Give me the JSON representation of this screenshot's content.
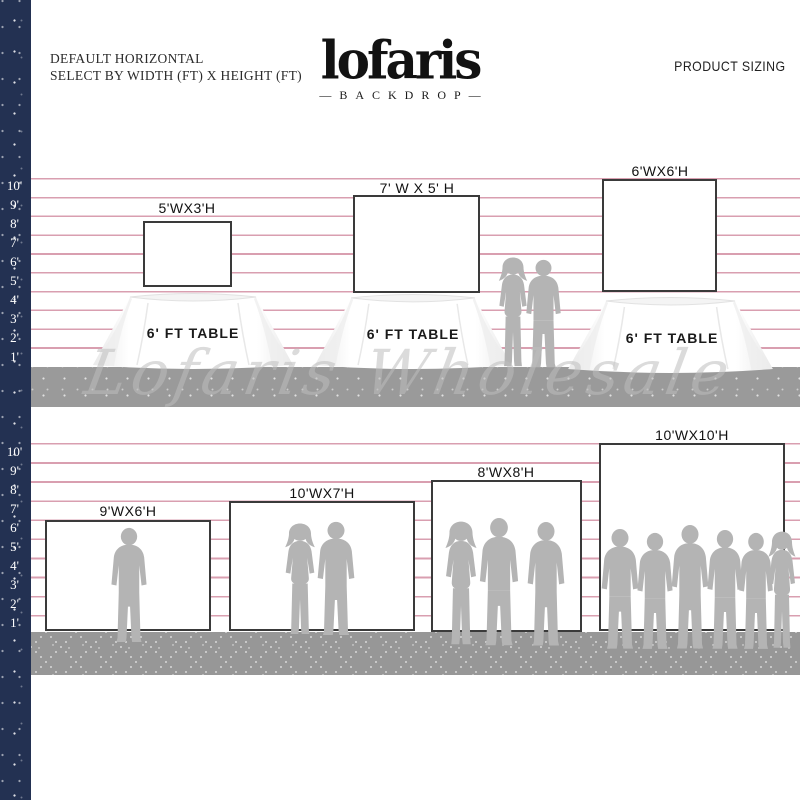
{
  "header": {
    "line1": "DEFAULT HORIZONTAL",
    "line2": "SELECT BY WIDTH (FT) X HEIGHT (FT)",
    "logo": "lofaris",
    "logo_sub": "—BACKDROP—",
    "right": "PRODUCT SIZING"
  },
  "watermark": "Lofaris Wholesale",
  "ruler_top": {
    "labels": [
      "10'",
      "9'",
      "8'",
      "7'",
      "6'",
      "5'",
      "4'",
      "3'",
      "2'",
      "1'"
    ]
  },
  "ruler_bottom": {
    "labels": [
      "10'",
      "9'",
      "8'",
      "7'",
      "6'",
      "5'",
      "4'",
      "3'",
      "2'",
      "1'"
    ]
  },
  "top_row": {
    "backdrops": [
      {
        "size": "5'WX3'H"
      },
      {
        "size": "7' W X 5' H"
      },
      {
        "size": "6'WX6'H"
      }
    ],
    "tables": [
      {
        "label": "6' FT TABLE"
      },
      {
        "label": "6' FT TABLE"
      },
      {
        "label": "6' FT TABLE"
      }
    ]
  },
  "bottom_row": {
    "backdrops": [
      {
        "size": "9'WX6'H"
      },
      {
        "size": "10'WX7'H"
      },
      {
        "size": "8'WX8'H"
      },
      {
        "size": "10'WX10'H"
      }
    ]
  },
  "colors": {
    "navy": "#233152",
    "line_pink": "#d99fb0",
    "floor_gray": "#999999",
    "silhouette": "#b4b4b4"
  }
}
